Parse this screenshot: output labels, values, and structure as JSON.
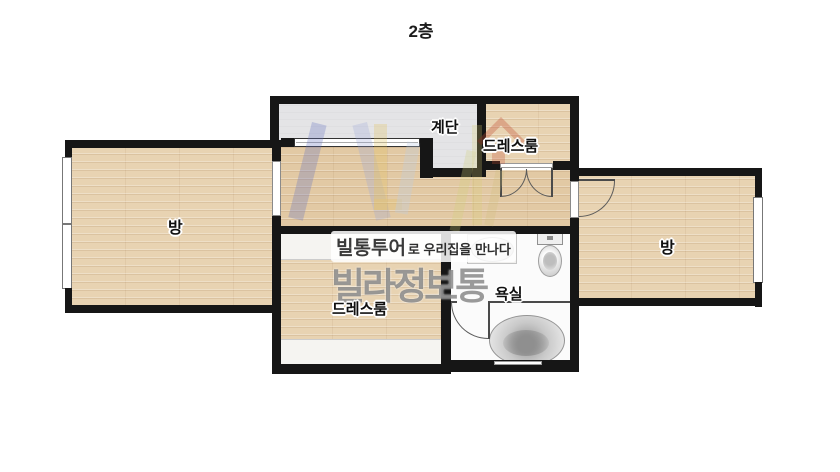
{
  "title": "2층",
  "rooms": {
    "left_room": {
      "label": "방"
    },
    "right_room": {
      "label": "방"
    },
    "stairs": {
      "label": "계단"
    },
    "top_dressroom": {
      "label": "드레스룸"
    },
    "bottom_dressroom": {
      "label": "드레스룸"
    },
    "bathroom": {
      "label": "욕실"
    }
  },
  "watermark": {
    "tagline_bold": "빌통투어",
    "tagline_rest": "로 우리집을 만나다",
    "brand": "빌라정보통"
  },
  "icons": [
    "bathtub-icon",
    "toilet-icon",
    "sink-icon",
    "door-arc-icon",
    "double-door-icon",
    "window-icon",
    "house-logo-icon",
    "logo-letters-icon"
  ],
  "colors": {
    "wall": "#161616",
    "wood_floor": "#e8d3b2",
    "stairs_floor": "#e4e4e6",
    "bathroom_floor": "#fbfbfb",
    "closet": "#f5f4f1",
    "logo_blue": "#6673c0",
    "logo_blue_light": "#99a6d8",
    "logo_yellow": "#e2bf55",
    "logo_sky": "#b9cce4",
    "logo_green": "#cfd078",
    "logo_red": "#c1492f",
    "brand_gray": "#787878"
  }
}
